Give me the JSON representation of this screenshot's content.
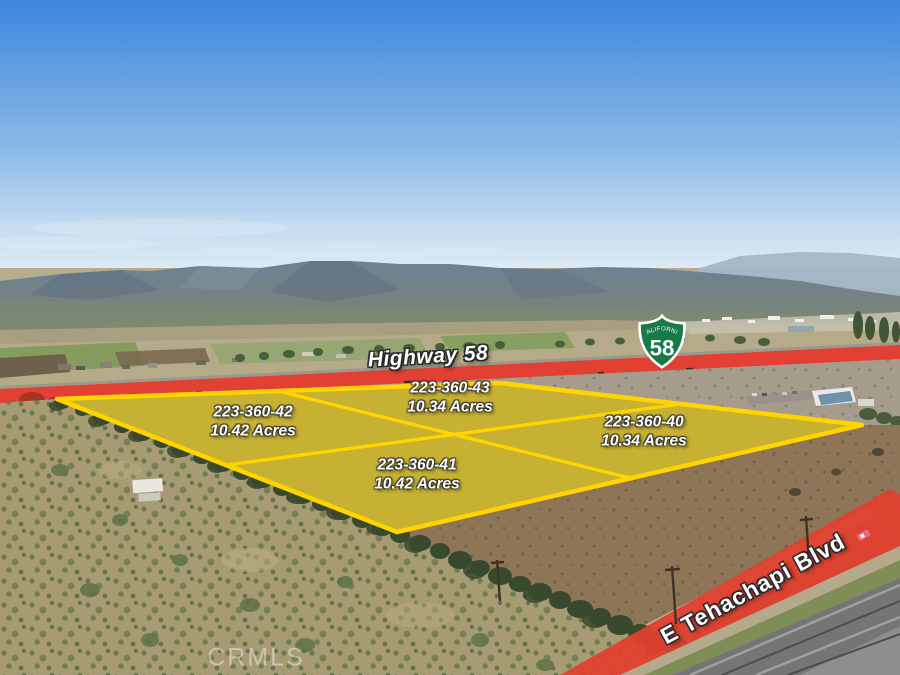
{
  "annotations": {
    "highway_label": "Highway 58",
    "street_label": "E Tehachapi Blvd",
    "watermark": "CRMLS"
  },
  "route_shield": {
    "state": "CALIFORNIA",
    "route": "58"
  },
  "parcels": [
    {
      "apn": "223-360-42",
      "acres": "10.42 Acres"
    },
    {
      "apn": "223-360-43",
      "acres": "10.34 Acres"
    },
    {
      "apn": "223-360-40",
      "acres": "10.34 Acres"
    },
    {
      "apn": "223-360-41",
      "acres": "10.42 Acres"
    }
  ],
  "icons": {
    "route_shield": "california-route-shield"
  },
  "colors": {
    "parcel_outline": "#FFD400",
    "parcel_fill": "rgba(255,208,0,0.48)",
    "road_highlight": "#E6392B",
    "shield_green": "#187B45",
    "sky_top": "#3D85DC",
    "sky_horizon": "#DCEAF4"
  }
}
